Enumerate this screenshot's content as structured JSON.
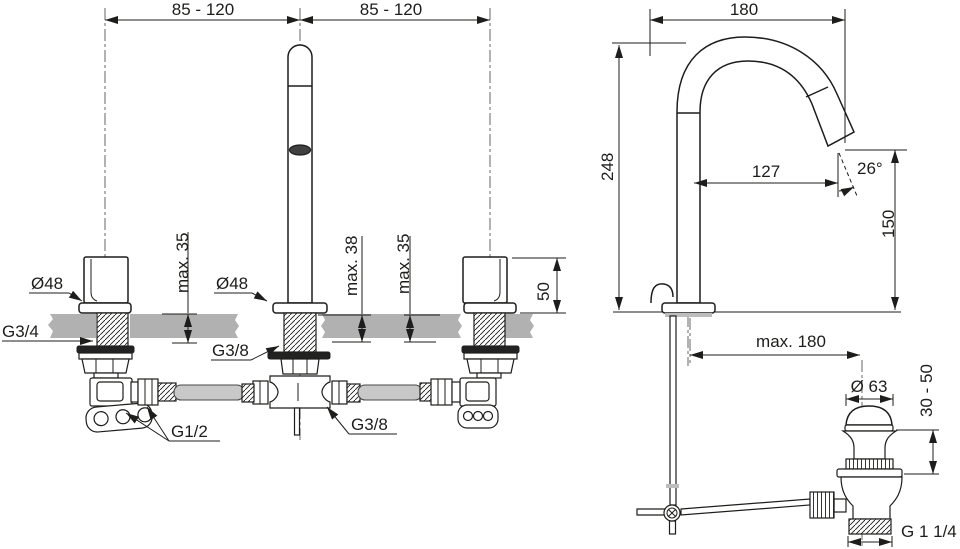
{
  "title": "Basin mixer technical dimension drawing",
  "colors": {
    "line": "#1d1d1b",
    "countertop_gray": "#b1b1b1",
    "hose_gray": "#c8c8c8",
    "gasket_dark": "#222222",
    "background": "#ffffff"
  },
  "front": {
    "dim_spacing_left": "85 - 120",
    "dim_spacing_right": "85 - 120",
    "label_left_flange_dia": "Ø48",
    "label_left_thread": "G3/4",
    "dim_left_deck": "max. 35",
    "label_spout_flange_dia": "Ø48",
    "label_spout_thread": "G3/8",
    "dim_spout_deck": "max. 38",
    "dim_right_deck": "max. 35",
    "dim_handle_height": "50",
    "label_supply_thread": "G1/2",
    "label_outlet_thread": "G3/8"
  },
  "side": {
    "dim_spout_span": "180",
    "dim_total_height": "248",
    "dim_spout_reach": "127",
    "dim_spray_angle": "26°",
    "dim_outlet_height": "150",
    "dim_rod_reach": "max. 180",
    "dim_drain_cap_dia": "Ø 63",
    "dim_drain_depth_range": "30 - 50",
    "label_drain_thread": "G 1 1/4"
  }
}
